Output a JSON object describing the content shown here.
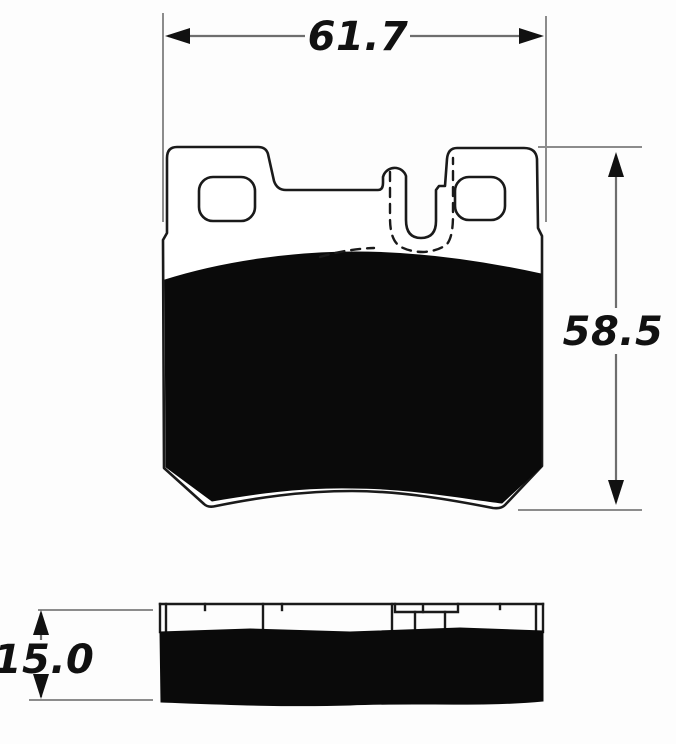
{
  "drawing": {
    "type": "technical-drawing-brake-pad",
    "dimensions": {
      "width": "61.7",
      "height": "58.5",
      "thickness": "15.0"
    },
    "colors": {
      "outline": "#1a1a1a",
      "friction_fill": "#0a0a0a",
      "dimension_line": "#6e6e6e",
      "extension_line": "#8c8c8c",
      "text": "#111111",
      "background": "#fdfdfd"
    }
  }
}
